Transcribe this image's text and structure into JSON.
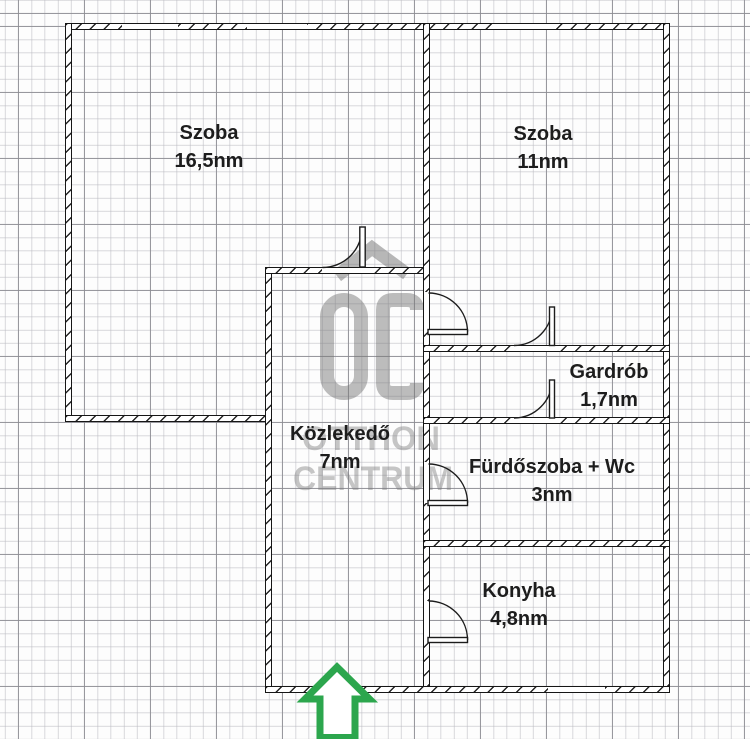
{
  "plan": {
    "rooms": [
      {
        "name": "Szoba",
        "area": "16,5nm"
      },
      {
        "name": "Szoba",
        "area": "11nm"
      },
      {
        "name": "Gardrób",
        "area": "1,7nm"
      },
      {
        "name": "Fürdőszoba + Wc",
        "area": "3nm"
      },
      {
        "name": "Konyha",
        "area": "4,8nm"
      },
      {
        "name": "Közlekedő",
        "area": "7nm"
      }
    ],
    "entrance": {
      "symbol": "up-arrow",
      "color": "#2CA64D"
    }
  },
  "watermark": {
    "monogram": "OC",
    "line1": "OTTHON",
    "line2": "CENTRUM",
    "color": "#7a7a7a"
  }
}
